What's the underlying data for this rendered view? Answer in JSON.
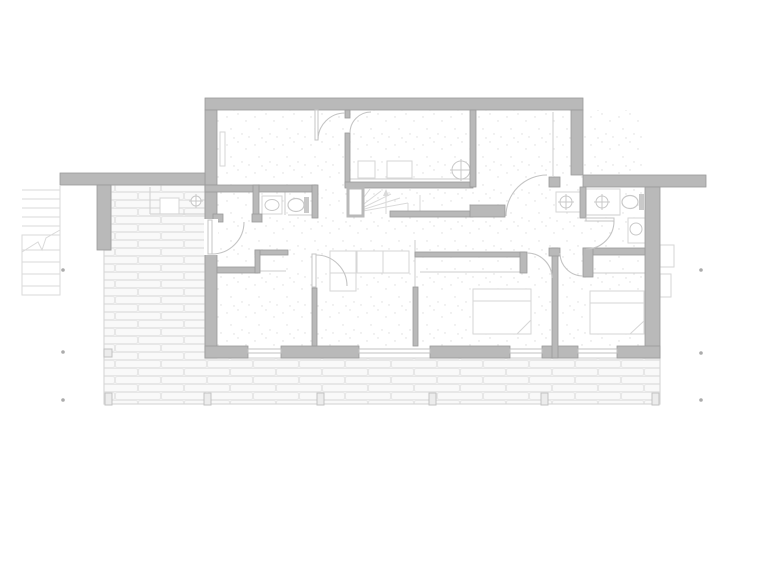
{
  "meta": {
    "drawing_type": "residential-floor-plan",
    "canvas_width": 768,
    "canvas_height": 576
  },
  "colors": {
    "background": "#ffffff",
    "wall_fill": "#b9b9b9",
    "wall_stroke": "#9a9a9a",
    "door_stroke": "#c4c4c4",
    "light_stroke": "#d6d6d6",
    "fixture_stroke": "#c9c9c9",
    "tank_fill": "#c9c9c9",
    "terrace_tile_fill": "#f9f9f9",
    "terrace_tile_stroke": "#e7e7e7",
    "terrace_base": "#f4f4f4",
    "terrace_edge": "#d9d9d9",
    "speckle": "#dcdcdc",
    "marker": "#ababab",
    "post_fill": "#ececec",
    "post_stroke": "#c2c2c2",
    "stair_stroke": "#dadada",
    "window_stroke": "#c0c0c0"
  },
  "plan": {
    "walls": [
      [
        "top-wall",
        205,
        98,
        378,
        12
      ],
      [
        "upper-left-wall",
        205,
        110,
        12,
        77
      ],
      [
        "upper-right-wall",
        571,
        110,
        12,
        65
      ],
      [
        "left-wing-wall",
        60,
        173,
        145,
        12
      ],
      [
        "right-wing-wall",
        583,
        175,
        123,
        12
      ],
      [
        "left-main-wall",
        205,
        185,
        12,
        173
      ],
      [
        "left-stub-wall",
        97,
        185,
        14,
        65
      ],
      [
        "right-main-wall",
        645,
        187,
        15,
        171
      ],
      [
        "bottom-wall-a",
        205,
        346,
        43,
        12
      ],
      [
        "bottom-wall-b",
        281,
        346,
        78,
        12
      ],
      [
        "bottom-wall-c",
        430,
        346,
        80,
        12
      ],
      [
        "bottom-wall-d",
        542,
        346,
        36,
        12
      ],
      [
        "bottom-wall-e",
        617,
        346,
        43,
        12
      ],
      [
        "hall-top-wall",
        205,
        185,
        112,
        7
      ],
      [
        "hall-bath-partition-left",
        253,
        185,
        6,
        33
      ],
      [
        "hall-bath-partition-right",
        312,
        185,
        6,
        33
      ],
      [
        "hall-closet-cap",
        213,
        214,
        10,
        8
      ],
      [
        "hall-bath-cap",
        252,
        214,
        10,
        8
      ],
      [
        "utility-partition-stub",
        345,
        110,
        5,
        8
      ],
      [
        "utility-partition",
        345,
        133,
        5,
        54
      ],
      [
        "utility-bottom-wall",
        345,
        182,
        128,
        6
      ],
      [
        "upper-partition-2",
        470,
        110,
        6,
        77
      ],
      [
        "stair-bottom-wall",
        390,
        211,
        83,
        6
      ],
      [
        "hall-wall-upper-right",
        470,
        205,
        35,
        12
      ],
      [
        "sliding-cap",
        549,
        177,
        11,
        10
      ],
      [
        "bed2-closet-wall",
        415,
        252,
        110,
        5
      ],
      [
        "bed2-closet-cap",
        520,
        252,
        7,
        21
      ],
      [
        "partition-living-bed2",
        413,
        287,
        5,
        59
      ],
      [
        "partition-bed1-living",
        312,
        288,
        5,
        58
      ],
      [
        "bed1-top-wall",
        217,
        267,
        41,
        6
      ],
      [
        "bed1-closet-top",
        255,
        250,
        33,
        5
      ],
      [
        "bed1-closet-side",
        255,
        250,
        5,
        23
      ],
      [
        "partition-bed2-bed3",
        552,
        248,
        6,
        110
      ],
      [
        "bed23-cap",
        549,
        248,
        11,
        8
      ],
      [
        "bathroom-left-wall",
        580,
        187,
        6,
        31
      ],
      [
        "bathroom-bottom-wall",
        583,
        248,
        62,
        7
      ],
      [
        "bed3-closet-side",
        583,
        248,
        10,
        29
      ]
    ],
    "wall_gaps": [
      [
        205,
        219,
        12,
        36
      ]
    ],
    "windows": [
      [
        248,
        349,
        33,
        4
      ],
      [
        359,
        349,
        71,
        4
      ],
      [
        510,
        349,
        32,
        4
      ],
      [
        578,
        349,
        39,
        4
      ]
    ],
    "outlined_boxes": [
      [
        "stair-closet",
        348,
        188,
        15,
        28
      ]
    ],
    "door_leaves": [
      [
        "entry-door-leaf",
        208,
        220,
        4,
        34
      ],
      [
        "room1-door-leaf",
        315,
        110,
        3,
        30
      ],
      [
        "bedroom1-door-leaf",
        312,
        254,
        4,
        33
      ],
      [
        "bathroom-door-leaf",
        586,
        218,
        28,
        3
      ]
    ],
    "door_arcs": [
      [
        "entry-door-arc",
        "M212,254 A32,32 0 0 0 244,222"
      ],
      [
        "room1-door-arc",
        "M318,140 A27,27 0 0 1 345,113"
      ],
      [
        "utility-door-arc",
        "M350,133 A21,21 0 0 1 371,112"
      ],
      [
        "bedroom1-door-arc",
        "M316,255 A31,31 0 0 1 347,286"
      ],
      [
        "upper-right-room-door-arc",
        "M506,216 A41,41 0 0 1 547,175"
      ],
      [
        "bedroom3-door-arc",
        "M560,253 A23,23 0 0 0 583,276"
      ],
      [
        "bathroom-door-arc",
        "M614,221 A28,28 0 0 1 586,249"
      ],
      [
        "bedroom2-door-arc",
        "M527,253 A25,25 0 0 1 552,278"
      ]
    ],
    "thin_lines": [
      [
        "sliding-door-track",
        553,
        112,
        553,
        176
      ],
      [
        "sliding-screen",
        415,
        240,
        415,
        287
      ],
      [
        "porch-step-v",
        150,
        187,
        150,
        214
      ],
      [
        "porch-step-h",
        150,
        214,
        205,
        214
      ],
      [
        "bath-divider",
        285,
        192,
        285,
        215
      ],
      [
        "closet1-lintel",
        258,
        271,
        286,
        271
      ],
      [
        "closet2-lintel",
        420,
        272,
        520,
        272
      ],
      [
        "closet3-lintel",
        592,
        273,
        645,
        273
      ],
      [
        "shower-screen",
        587,
        215,
        620,
        215
      ],
      [
        "hall-bath-screen",
        288,
        215,
        317,
        215
      ],
      [
        "utility-counter",
        350,
        179,
        470,
        179
      ]
    ],
    "stair_lines": [
      [
        352,
        213,
        360,
        188
      ],
      [
        352,
        213,
        370,
        189
      ],
      [
        352,
        213,
        381,
        191
      ],
      [
        352,
        213,
        391,
        194
      ],
      [
        352,
        213,
        400,
        198
      ],
      [
        352,
        213,
        408,
        203
      ],
      [
        408,
        203,
        408,
        214
      ],
      [
        420,
        195,
        420,
        214
      ]
    ],
    "stair_arrow": {
      "line": [
        386,
        214,
        386,
        192
      ],
      "head": "383,196 389,196 386,189"
    },
    "boxes_light": [
      [
        "shower-tray",
        586,
        189,
        34,
        26
      ],
      [
        "niche-basin",
        556,
        192,
        29,
        20
      ],
      [
        "porch-sink",
        160,
        198,
        19,
        16
      ],
      [
        "washer",
        358,
        161,
        17,
        17
      ],
      [
        "dryer",
        387,
        161,
        25,
        17
      ],
      [
        "radiator",
        220,
        132,
        5,
        34
      ],
      [
        "exterior-step-1",
        660,
        245,
        14,
        22
      ],
      [
        "exterior-step-2",
        660,
        274,
        11,
        23
      ]
    ],
    "circles_cross": [
      [
        "shower-drain",
        602,
        202,
        6
      ],
      [
        "niche-drain",
        566,
        202,
        6
      ],
      [
        "porch-tap",
        196,
        201,
        5
      ],
      [
        "utility-basin",
        461,
        170,
        9
      ]
    ],
    "toilets": [
      [
        "toilet-hall-bath",
        296,
        205,
        8,
        6.5,
        304,
        197,
        5,
        16
      ],
      [
        "toilet-main-bath",
        630,
        202,
        8,
        6.5,
        639,
        194,
        5,
        16
      ]
    ],
    "sinks": [
      [
        "sink-hall-bath",
        262,
        196,
        20,
        18,
        272,
        205,
        7,
        5.5
      ],
      [
        "sink-main-bath",
        628,
        218,
        18,
        25,
        636,
        229,
        6,
        6
      ]
    ],
    "beds": [
      [
        "bed-middle",
        473,
        289,
        58,
        45,
        [
          [
            473,
            301,
            531,
            301
          ],
          [
            517,
            334,
            531,
            320
          ]
        ]
      ],
      [
        "bed-right",
        590,
        291,
        54,
        43,
        [
          [
            590,
            303,
            644,
            303
          ],
          [
            630,
            334,
            644,
            321
          ]
        ]
      ]
    ],
    "sofa": {
      "rects": [
        [
          330,
          251,
          79,
          22
        ],
        [
          330,
          251,
          26,
          40
        ]
      ],
      "lines": [
        [
          357,
          251,
          357,
          273
        ],
        [
          383,
          251,
          383,
          273
        ],
        [
          330,
          273,
          356,
          273
        ]
      ]
    },
    "terrace": {
      "path": "M111,185 L205,185 L205,358 L660,358 L660,404 L104,404 L104,250 L111,250 Z",
      "posts_x": [
        105,
        204,
        317,
        429,
        541,
        652
      ],
      "posts_y": 393,
      "post_w": 7,
      "post_h": 12,
      "corner_post": [
        104,
        349,
        8,
        8
      ]
    },
    "speckle_area": [
      217,
      110,
      428,
      237
    ],
    "exterior_stair": {
      "treads": [
        [
          22,
          190,
          60,
          190
        ],
        [
          22,
          199,
          60,
          199
        ],
        [
          22,
          208,
          60,
          208
        ],
        [
          22,
          217,
          60,
          217
        ],
        [
          22,
          226,
          60,
          226
        ]
      ],
      "lower_box": [
        22,
        235,
        38,
        60
      ],
      "lower_treads": [
        [
          22,
          250,
          60,
          250
        ],
        [
          22,
          262,
          60,
          262
        ],
        [
          22,
          274,
          60,
          274
        ],
        [
          22,
          286,
          60,
          286
        ]
      ],
      "break_line": "22,252 38,242 42,250 46,238 60,230",
      "edge": [
        60,
        186,
        60,
        295
      ]
    },
    "markers": [
      [
        63,
        270
      ],
      [
        63,
        352
      ],
      [
        63,
        400
      ],
      [
        701,
        270
      ],
      [
        701,
        353
      ],
      [
        701,
        400
      ]
    ]
  }
}
